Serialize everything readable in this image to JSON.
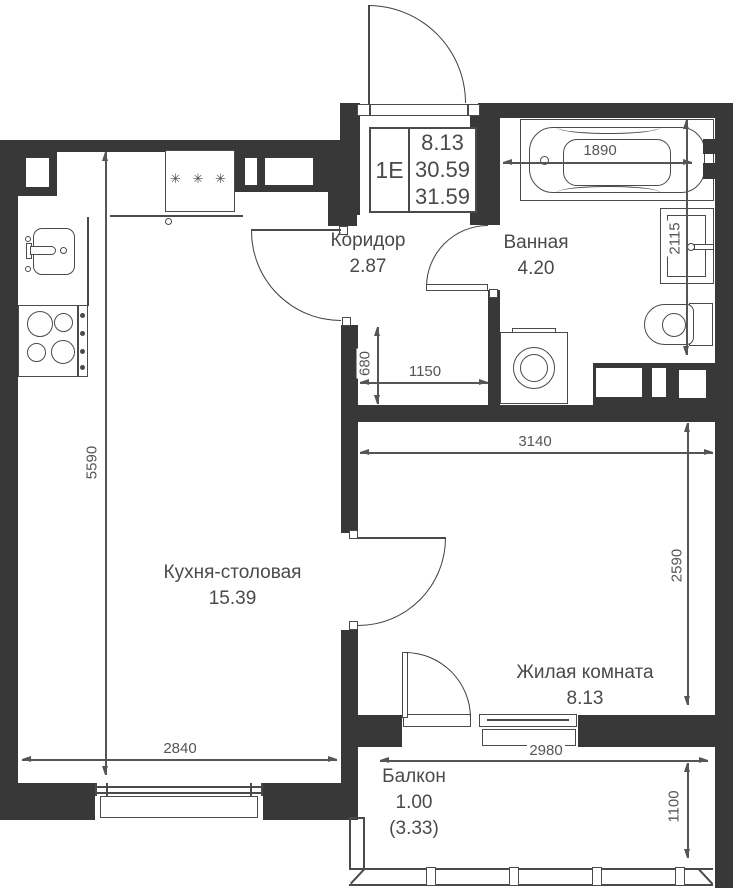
{
  "plan": {
    "title_block": {
      "unit_type": "1Е",
      "values": [
        "8.13",
        "30.59",
        "31.59"
      ]
    },
    "rooms": {
      "corridor": {
        "name": "Коридор",
        "area": "2.87"
      },
      "bathroom": {
        "name": "Ванная",
        "area": "4.20"
      },
      "kitchen": {
        "name": "Кухня-столовая",
        "area": "15.39"
      },
      "living": {
        "name": "Жилая комната",
        "area": "8.13"
      },
      "balcony": {
        "name": "Балкон",
        "area": "1.00",
        "area_total": "(3.33)"
      }
    },
    "dimensions": {
      "kitchen_height": "5590",
      "bathtub_width": "1890",
      "bathroom_height": "2115",
      "niche_depth": "680",
      "niche_width": "1150",
      "living_width": "3140",
      "living_height": "2590",
      "kitchen_width": "2840",
      "balcony_width": "2980",
      "balcony_height": "1100"
    },
    "symbols": {
      "fridge": "✳ ✳ ✳"
    },
    "colors": {
      "wall": "#383838",
      "line": "#4a4a4a",
      "dim": "#555555",
      "bg": "#ffffff"
    }
  }
}
